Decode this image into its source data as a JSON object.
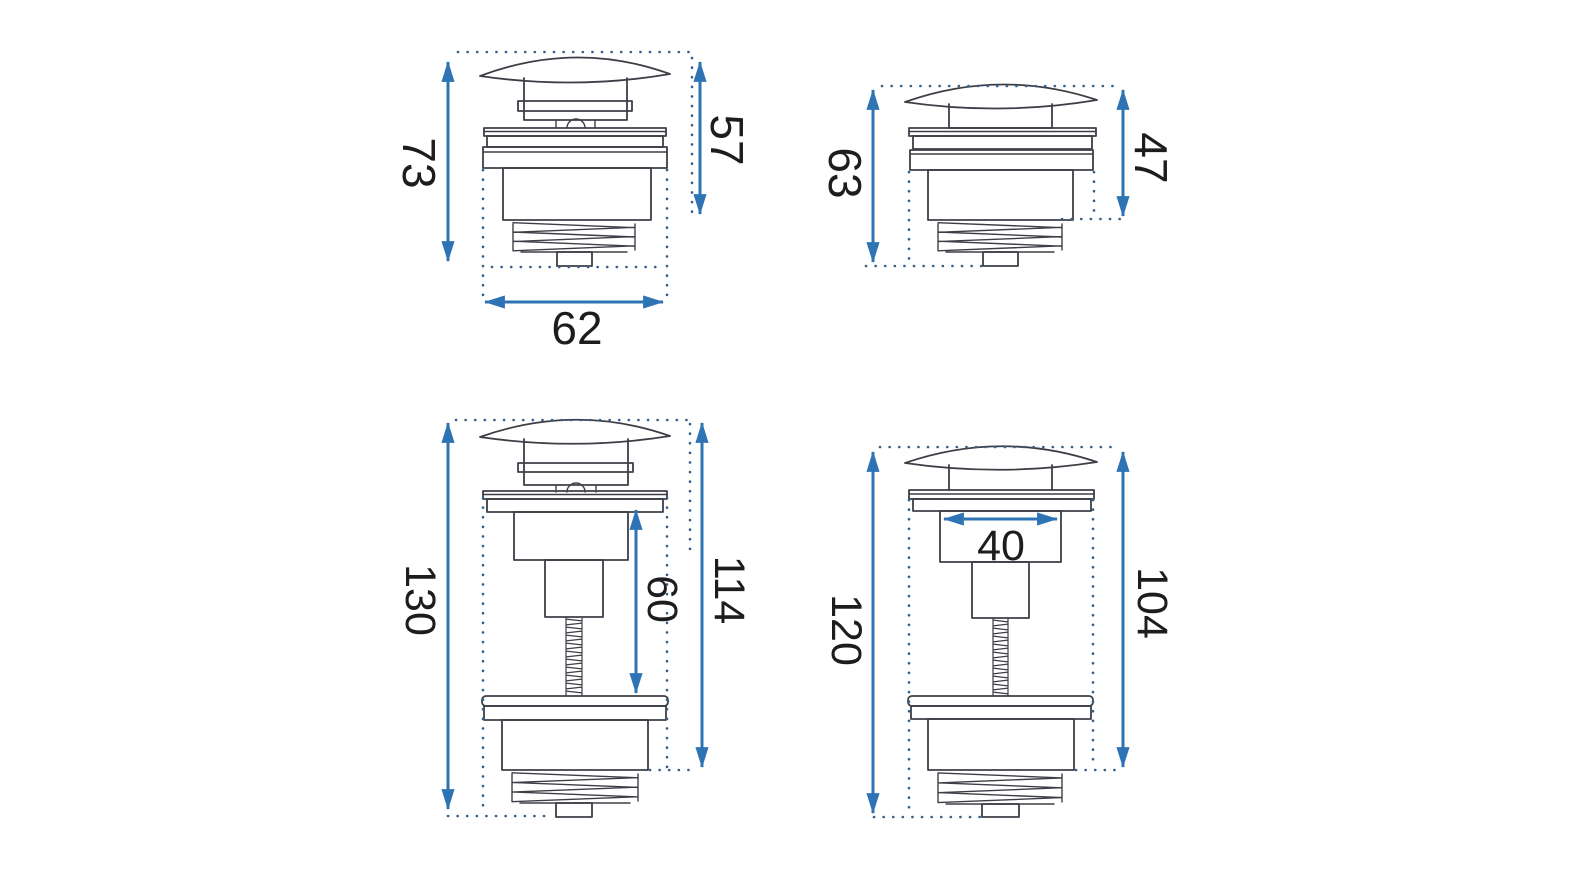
{
  "colors": {
    "dimension_blue": "#2E74B5",
    "drawing_outline": "#3E3E47",
    "dotted_guides": "#35608C",
    "label_text": "#1D1D1F",
    "background": "#FFFFFF"
  },
  "figures": [
    {
      "id": "top-left",
      "variant": "short-valve",
      "dims": {
        "left": "73",
        "right": "57",
        "bottom": "62"
      }
    },
    {
      "id": "top-right",
      "variant": "short-valve",
      "dims": {
        "left": "63",
        "right": "47"
      }
    },
    {
      "id": "bottom-left",
      "variant": "tall-valve-threaded-rod",
      "dims": {
        "left": "130",
        "middle": "60",
        "right": "114"
      }
    },
    {
      "id": "bottom-right",
      "variant": "tall-valve-threaded-rod",
      "dims": {
        "left": "120",
        "inner_width": "40",
        "right": "104"
      }
    }
  ]
}
